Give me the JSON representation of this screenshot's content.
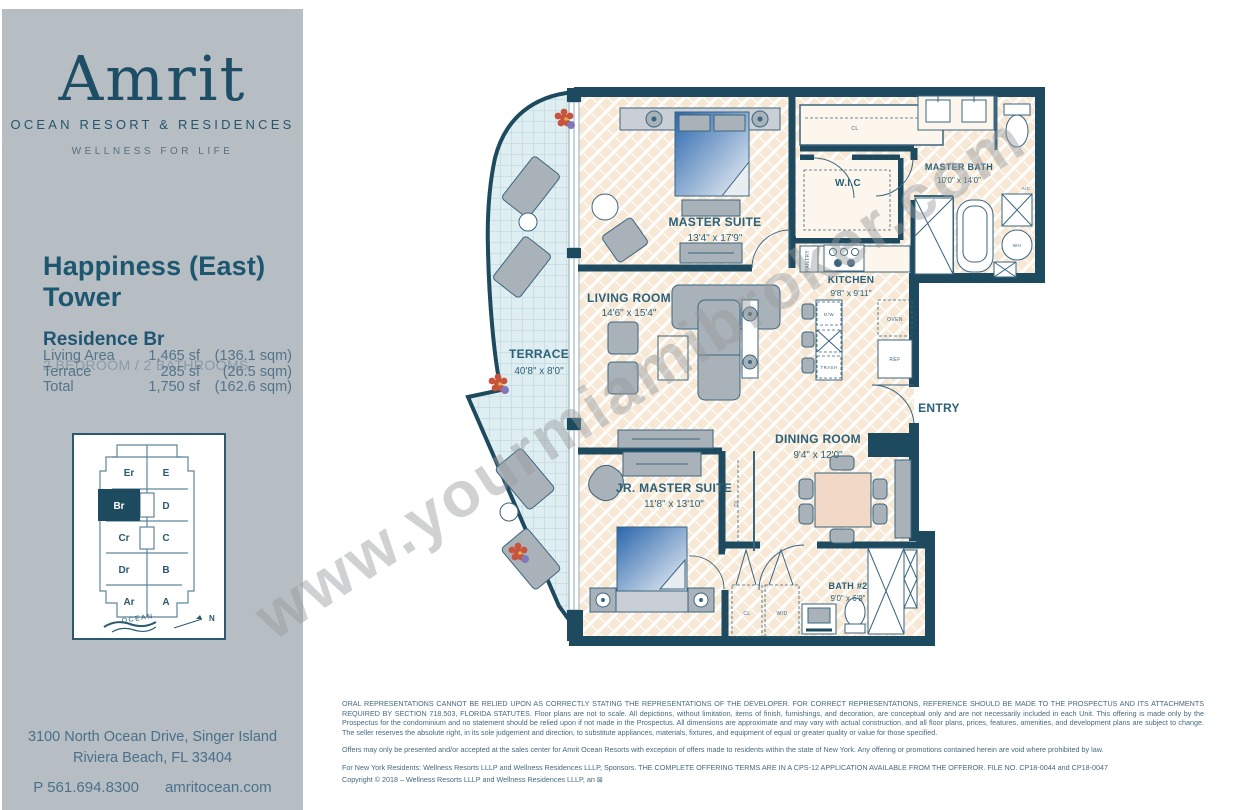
{
  "brand": {
    "logo_text": "Amrit",
    "logo_sub": "OCEAN RESORT & RESIDENCES",
    "tagline": "WELLNESS FOR LIFE"
  },
  "listing": {
    "tower": "Happiness (East) Tower",
    "residence": "Residence Br",
    "config": "2 BEDROOM / 2 BATHROOMS",
    "stats": [
      {
        "label": "Living Area",
        "sf": "1,465 sf",
        "sqm": "(136.1 sqm)"
      },
      {
        "label": "Terrace",
        "sf": "285 sf",
        "sqm": "(26.5 sqm)"
      },
      {
        "label": "Total",
        "sf": "1,750 sf",
        "sqm": "(162.6 sqm)"
      }
    ]
  },
  "keyplan": {
    "units": [
      "Er",
      "E",
      "Br",
      "D",
      "Cr",
      "C",
      "Dr",
      "B",
      "Ar",
      "A"
    ],
    "highlighted_unit": "Br",
    "ocean_label": "OCEAN",
    "north_label": "N"
  },
  "contact": {
    "address_line1": "3100 North Ocean Drive, Singer Island",
    "address_line2": "Riviera Beach, FL 33404",
    "phone": "P 561.694.8300",
    "website": "amritocean.com"
  },
  "plan": {
    "watermark": "www.yourmiamibroker.com",
    "rooms": [
      {
        "name": "MASTER  SUITE",
        "dims": "13'4\" x 17'9\""
      },
      {
        "name": "MASTER BATH",
        "dims": "10'0\" x 14'0\""
      },
      {
        "name": "W.I.C",
        "dims": ""
      },
      {
        "name": "KITCHEN",
        "dims": "9'8\" x 9'11\""
      },
      {
        "name": "LIVING ROOM",
        "dims": "14'6\" x 15'4\""
      },
      {
        "name": "TERRACE",
        "dims": "40'8\" x 8'0\""
      },
      {
        "name": "DINING ROOM",
        "dims": "9'4\" x 12'0\""
      },
      {
        "name": "ENTRY",
        "dims": ""
      },
      {
        "name": "JR. MASTER SUITE",
        "dims": "11'8\" x 13'10\""
      },
      {
        "name": "BATH #2",
        "dims": "9'0\" x 6'9\""
      }
    ],
    "fixtures": {
      "cl": "CL",
      "pantry": "PANTRY",
      "dw": "D/W",
      "trash": "TRASH",
      "oven": "OVEN",
      "ref": "REF",
      "wd": "W/D",
      "wh": "WH",
      "ac": "A/C"
    }
  },
  "legal": {
    "p1": "ORAL REPRESENTATIONS CANNOT BE RELIED UPON AS CORRECTLY STATING THE REPRESENTATIONS OF THE DEVELOPER. FOR CORRECT REPRESENTATIONS, REFERENCE SHOULD BE MADE TO THE PROSPECTUS AND ITS ATTACHMENTS REQUIRED BY SECTION 718.503, FLORIDA STATUTES.  Floor plans are not to scale. All depictions, without limitation, items of finish, furnishings, and decoration, are conceptual only and are not necessarily included in each Unit. This offering is made only by the Prospectus for the condominium and no statement should be relied upon if not made in the Prospectus. All dimensions are approximate and may vary with actual construction, and all floor plans, prices, features, amenities, and development plans are subject to change. The seller reserves the absolute right, in its sole judgement and direction, to substitute appliances, materials, fixtures, and equipment of equal or greater quality or value for those specified.",
    "p2": "Offers may only be presented and/or accepted at the sales center for Amrit Ocean Resorts with exception of offers made to residents within the state of New York.  Any offering or promotions contained herein are void where prohibited by law.",
    "p3": "For New York Residents: Wellness Resorts LLLP and Wellness Residences LLLP, Sponsors. THE COMPLETE OFFERING TERMS ARE IN A CPS-12 APPLICATION AVAILABLE FROM THE OFFEROR. FILE NO. CP18-0044 and CP18-0047",
    "p4": "Copyright © 2018 – Wellness Resorts LLLP and Wellness Residences LLLP, an ⊠"
  },
  "colors": {
    "accent_teal": "#1d4a5f",
    "sidebar_gray": "#b6bdc3",
    "floor_cream": "#f6e8d5",
    "terrace_blue": "#dfeef1",
    "bed_blue": "#2a66ad",
    "dining_table": "#f2d8c6"
  }
}
